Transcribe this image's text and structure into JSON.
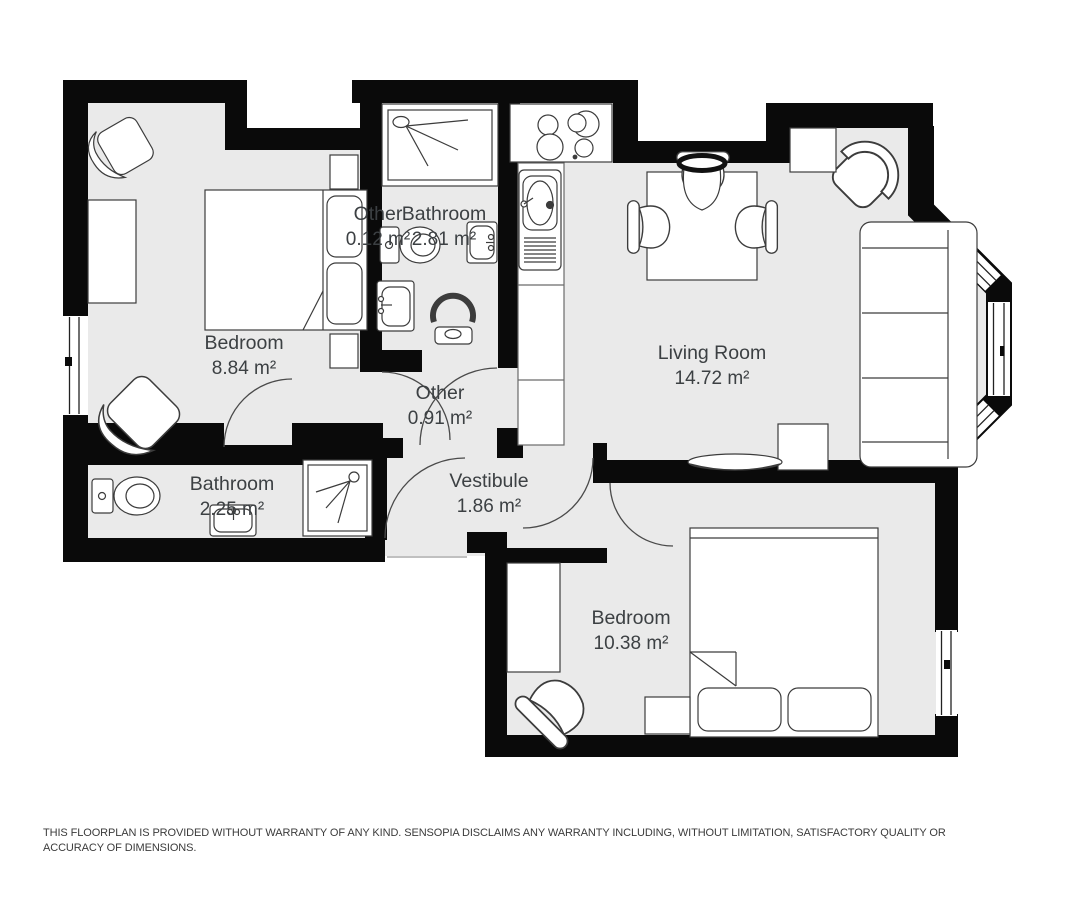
{
  "floorplan": {
    "rooms": [
      {
        "name": "Bedroom",
        "area": "8.84 m²"
      },
      {
        "name": "Other",
        "area": "0.12 m²"
      },
      {
        "name": "Bathroom",
        "area": "2.81 m²"
      },
      {
        "name": "Other",
        "area": "0.91 m²"
      },
      {
        "name": "Living Room",
        "area": "14.72 m²"
      },
      {
        "name": "Bathroom",
        "area": "2.25 m²"
      },
      {
        "name": "Vestibule",
        "area": "1.86 m²"
      },
      {
        "name": "Bedroom",
        "area": "10.38 m²"
      }
    ],
    "colors": {
      "wall": "#0a0a0a",
      "floor": "#eaeaea",
      "furniture_stroke": "#3c3c3c",
      "label_text": "#3c4043"
    }
  },
  "disclaimer": "THIS FLOORPLAN IS PROVIDED WITHOUT WARRANTY OF ANY KIND. SENSOPIA DISCLAIMS ANY WARRANTY INCLUDING, WITHOUT LIMITATION, SATISFACTORY QUALITY OR ACCURACY OF DIMENSIONS."
}
